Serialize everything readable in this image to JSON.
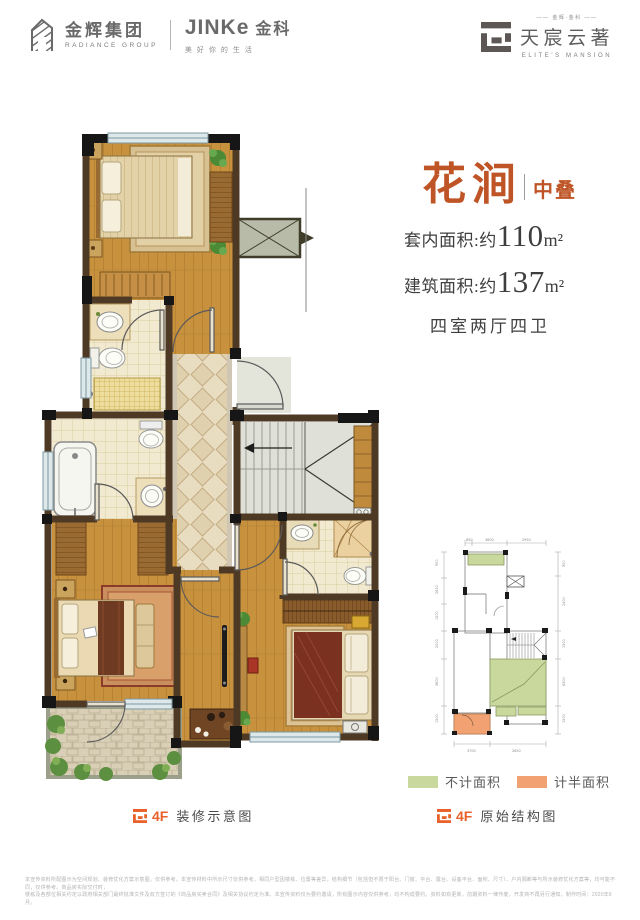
{
  "header": {
    "radiance": {
      "cn": "金辉集团",
      "en": "RADIANCE GROUP"
    },
    "jinke": {
      "en": "JINKe",
      "cn": "金科",
      "slogan": "美好你的生活"
    },
    "mansion": {
      "small": "—— 金辉·金科 ——",
      "cn": "天宸云著",
      "en": "ELITE'S MANSION"
    }
  },
  "info": {
    "title": "花涧",
    "subtitle": "中叠",
    "area1_label": "套内面积:约",
    "area1_value": "110",
    "area1_unit": "m²",
    "area2_label": "建筑面积:约",
    "area2_value": "137",
    "area2_unit": "m²",
    "rooms": "四室两厅四卫"
  },
  "legend": {
    "green_label": "不计面积",
    "orange_label": "计半面积"
  },
  "captions": {
    "left_floor": "4F",
    "left_text": "装修示意图",
    "right_floor": "4F",
    "right_text": "原始结构图"
  },
  "structural": {
    "dims_top": [
      "850",
      "3600",
      "2950"
    ],
    "dims_left": [
      "900",
      "2620",
      "1500",
      "2000",
      "3600",
      "1500"
    ],
    "dims_right": [
      "900",
      "2400",
      "1500",
      "6300",
      "1500"
    ],
    "dims_bottom": [
      "3700",
      "2850"
    ]
  },
  "disclaimer": {
    "line1": "本宣传资料所配图示为空间规划、装修优化方案示意图，仅供参考。本宣传材料中所示尺寸仅供参考。相同户型因楼栋、位置等差异，结构细节（包括但不限于阳台、门窗、平台、露台、设备平台、面积、尺寸）、户内隔断等与所示装修优化方案等，均可能不同，仅供参考。商品房实际交付时，",
    "line2": "楼栋及各部位相关约定以政府相关部门最终批准文件及双方签订的《商品房买卖合同》及相关协议约定为准。本宣传资料仅为要约邀请，所有图示内容仅供参考，均不构成要约。资料如有更新，前期资料一律作废，开发商不再另行通知。制作时间：2020年6月。"
  },
  "colors": {
    "accent_orange": "#bf5526",
    "caption_orange": "#e8622a",
    "legend_green": "#c9d89d",
    "legend_orange": "#f2a173",
    "logo_gray": "#6a6a6a",
    "wood": "#c8913e",
    "wall": "#4e3a24"
  }
}
